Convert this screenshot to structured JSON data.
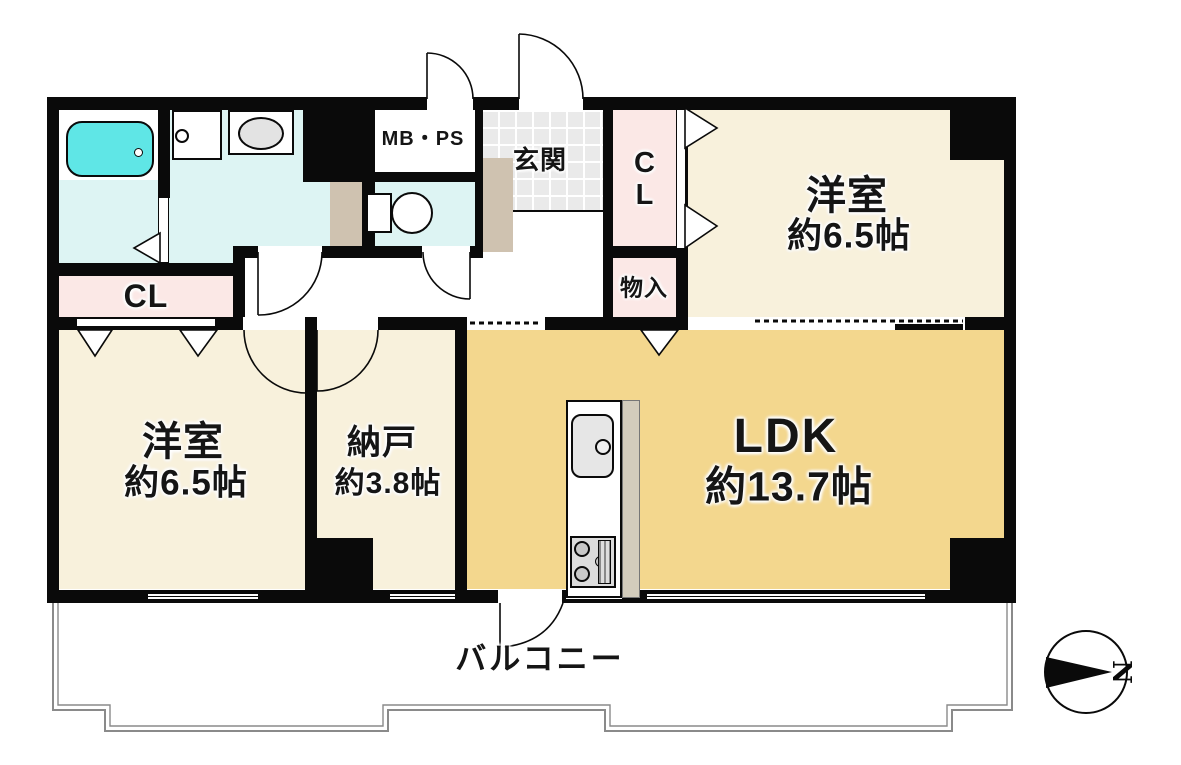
{
  "rooms": {
    "western_top_right": {
      "name": "洋室",
      "area": "約6.5帖"
    },
    "western_bottom_left": {
      "name": "洋室",
      "area": "約6.5帖"
    },
    "storage_room": {
      "name": "納戸",
      "area": "約3.8帖"
    },
    "ldk": {
      "name": "LDK",
      "area": "約13.7帖"
    }
  },
  "labels": {
    "entrance": "玄関",
    "closet_upper": "CL",
    "closet_left": "CL",
    "storage_box": "物入",
    "meter_pipe_space": "MB・PS",
    "balcony": "バルコニー",
    "compass_north": "N"
  },
  "icons": {
    "compass": "north-arrow-compass",
    "fixtures": [
      "bathtub",
      "washing-machine-pan",
      "vanity-sink",
      "toilet",
      "kitchen-sink",
      "gas-stove"
    ]
  },
  "colors": {
    "wall": "#0a0a0a",
    "room_cream": "#F8F1DC",
    "room_ldk_tan": "#F3D78E",
    "closet_pink": "#FBE8E6",
    "wet_area_cyan": "#DDF4F3",
    "bathtub_cyan": "#5FE6E6",
    "entrance_tile_gray": "#EAEAEA",
    "cabinet_tan": "#CFC2B0",
    "balcony_line_gray": "#8a8a8a"
  }
}
